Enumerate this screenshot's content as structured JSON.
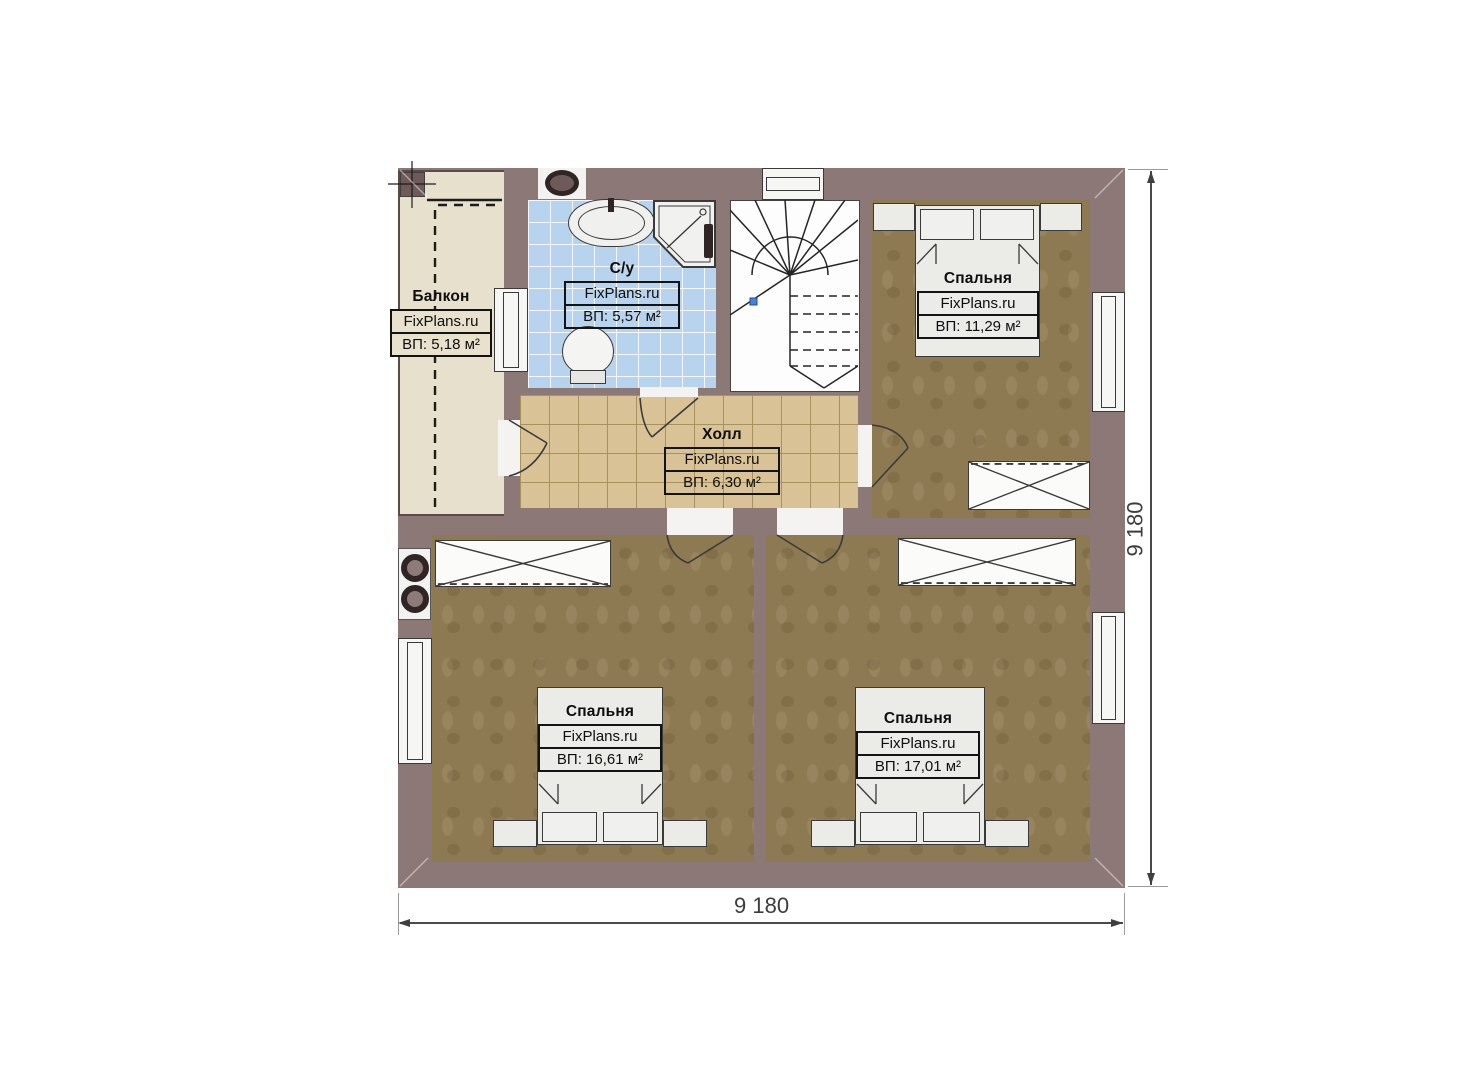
{
  "rooms": {
    "balcony": {
      "name": "Балкон",
      "watermark": "FixPlans.ru",
      "area": "ВП: 5,18 м²"
    },
    "bathroom": {
      "name": "С/у",
      "watermark": "FixPlans.ru",
      "area": "ВП: 5,57 м²"
    },
    "hall": {
      "name": "Холл",
      "watermark": "FixPlans.ru",
      "area": "ВП: 6,30 м²"
    },
    "bedroom_top": {
      "name": "Спальня",
      "watermark": "FixPlans.ru",
      "area": "ВП: 11,29 м²"
    },
    "bedroom_bottom_left": {
      "name": "Спальня",
      "watermark": "FixPlans.ru",
      "area": "ВП: 16,61 м²"
    },
    "bedroom_bottom_right": {
      "name": "Спальня",
      "watermark": "FixPlans.ru",
      "area": "ВП: 17,01 м²"
    }
  },
  "dimensions": {
    "bottom": "9 180",
    "right": "9 180"
  },
  "colors": {
    "wall": "#8c7877",
    "bedroom_floor": "#8e7a52",
    "hall_floor": "#d9c295",
    "bathroom_floor": "#b7d3ee",
    "balcony_floor": "#e7e0cd",
    "furniture": "#ebebe8",
    "dimension_text": "#3d3d3d",
    "stair_marker": "#4a7fd4"
  },
  "fixtures": [
    "stairs",
    "sink",
    "shower-cabin",
    "toilet",
    "bed",
    "wardrobe",
    "nightstand",
    "stove-flue",
    "vent"
  ]
}
